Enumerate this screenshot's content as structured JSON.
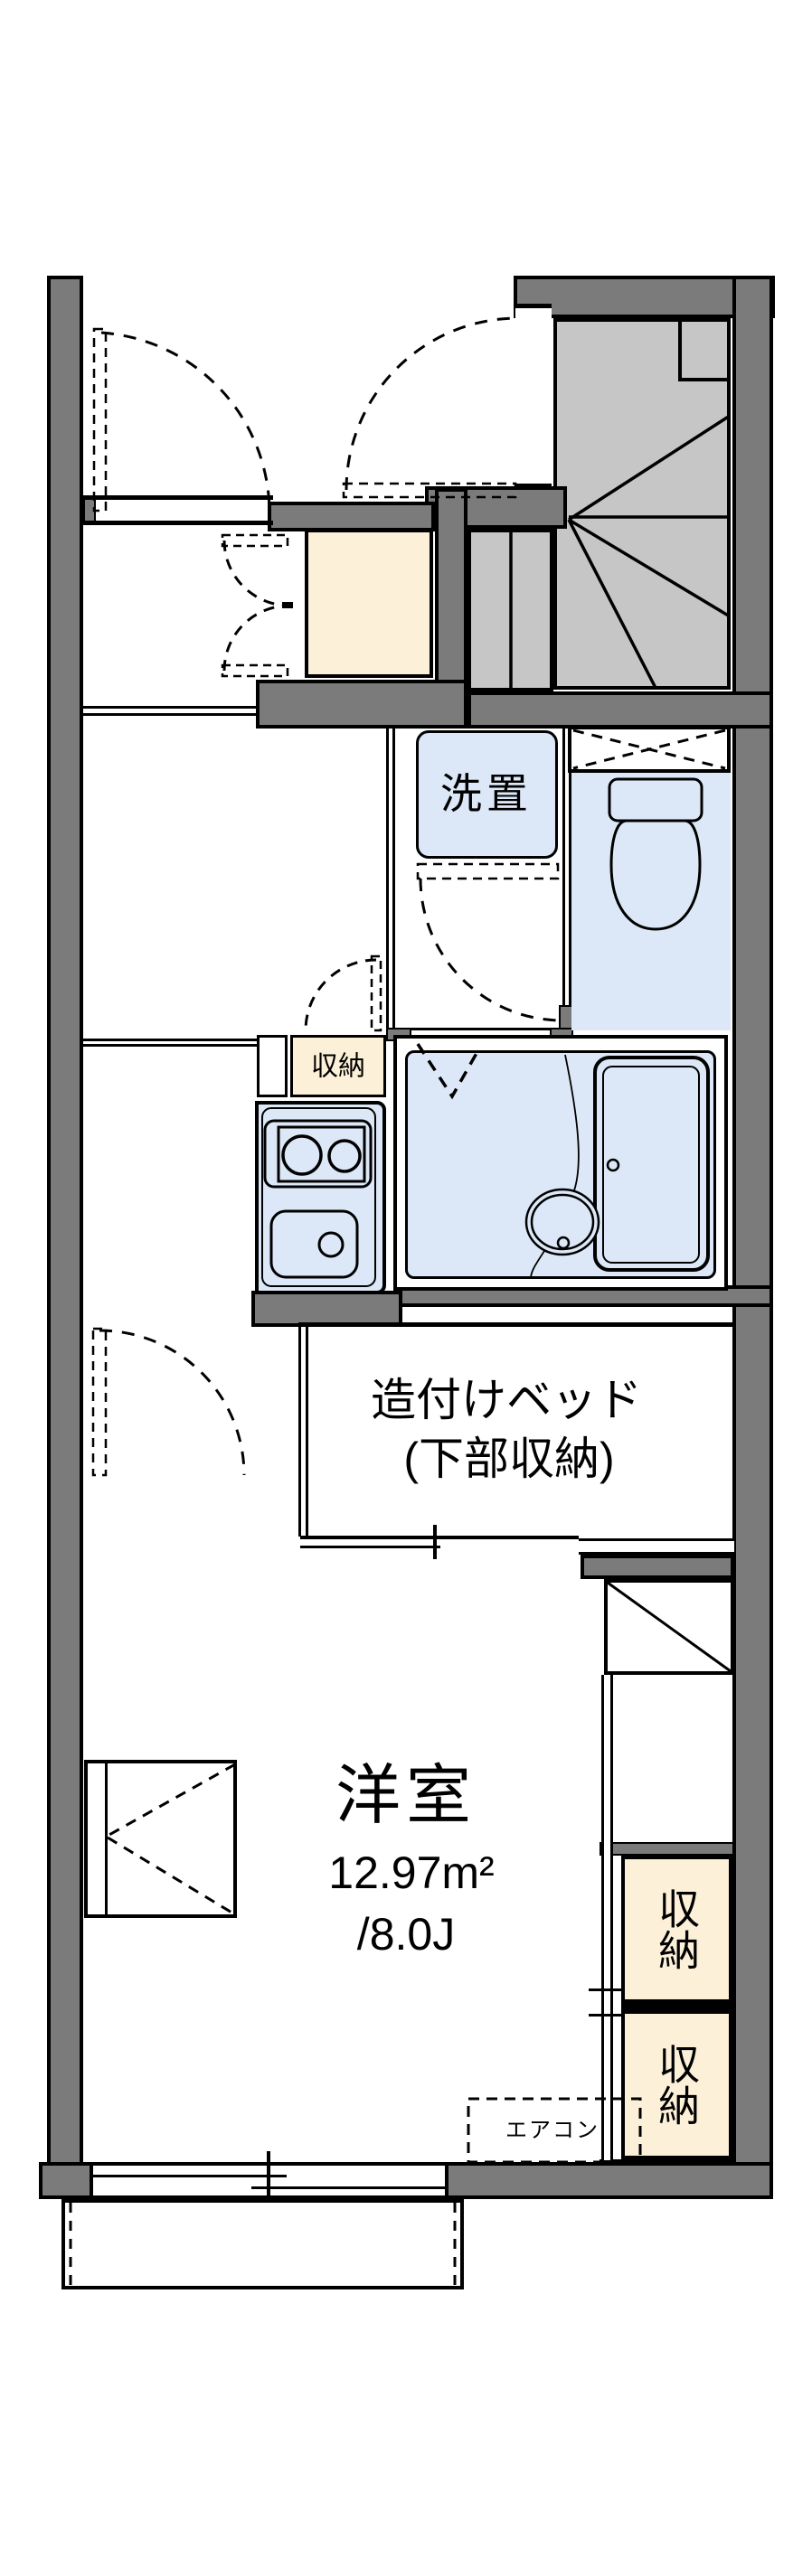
{
  "plan": {
    "title": "apartment-floor-plan",
    "labels": {
      "washer": "洗置",
      "storage_small": "収納",
      "bed_line1": "造付けベッド",
      "bed_line2": "(下部収納)",
      "room_name": "洋室",
      "room_area_m2": "12.97m²",
      "room_area_jo": "/8.0J",
      "closet_upper": "収納",
      "closet_lower": "収納",
      "aircon": "エアコン"
    },
    "colors": {
      "wall": "#7b7b7b",
      "stairs": "#c6c6c6",
      "fixture_blue": "#dce8f7",
      "storage_cream": "#fcf0d8",
      "line": "#000000"
    }
  }
}
